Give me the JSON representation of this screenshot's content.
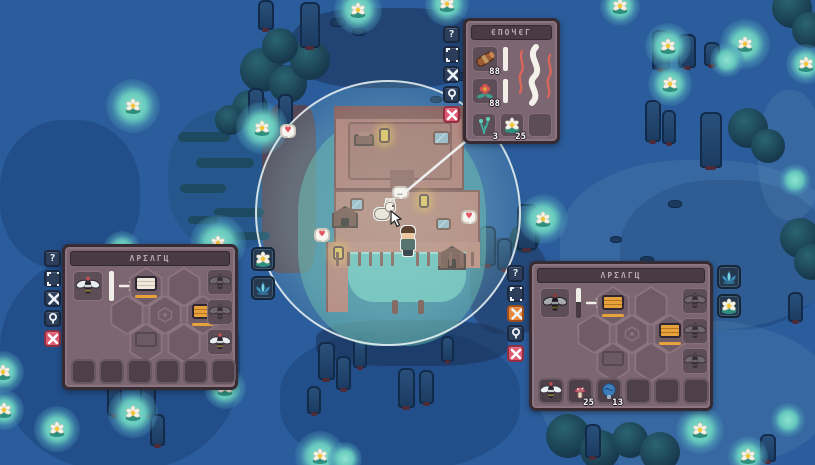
{
  "hud": {
    "help_glyph": "?",
    "smoker": {
      "title": "ЄΠΟЧЄΓ",
      "side_buttons": [
        "help",
        "resize",
        "move",
        "pin",
        "close"
      ],
      "fuel_slots": [
        {
          "item": "log",
          "timer": "88"
        },
        {
          "item": "red-flower",
          "timer": "88"
        }
      ],
      "output_slots": [
        {
          "item": "water-sprout",
          "count": "3"
        },
        {
          "item": "lily-flower",
          "count": "25"
        },
        {
          "item": "",
          "count": ""
        }
      ]
    },
    "apiary_left": {
      "title": "ΛΡΣΛΓЦ",
      "side_buttons": [
        "help",
        "resize",
        "move",
        "pin",
        "close"
      ],
      "input_item": "bee",
      "gauge_fill": "100%",
      "queue_slots": [
        "bee-silhouette",
        "bee-silhouette",
        "bee"
      ],
      "hex_cells": [
        "hive-box-white",
        "empty",
        "empty",
        "hex-marker",
        "hive-box-orange",
        "hive-box-faded",
        "empty"
      ],
      "inventory": [
        {
          "item": "",
          "count": ""
        },
        {
          "item": "",
          "count": ""
        },
        {
          "item": "",
          "count": ""
        },
        {
          "item": "",
          "count": ""
        },
        {
          "item": "",
          "count": ""
        },
        {
          "item": "",
          "count": ""
        }
      ],
      "floating_buttons": [
        "lily-flower",
        "lotus-flower"
      ]
    },
    "apiary_right": {
      "title": "ΛΡΣΛΓЦ",
      "side_buttons": [
        "help",
        "resize",
        "move-active",
        "pin",
        "close"
      ],
      "input_item": "bee",
      "gauge_fill": "45%",
      "queue_slots": [
        "bee-silhouette",
        "bee-silhouette",
        "bee-silhouette"
      ],
      "hex_cells": [
        "hive-box-orange",
        "empty",
        "empty",
        "hex-marker",
        "hive-box-orange",
        "hive-box-faded",
        "empty"
      ],
      "inventory": [
        {
          "item": "bee",
          "count": ""
        },
        {
          "item": "mushroom",
          "count": "25"
        },
        {
          "item": "blue-mushroom",
          "count": "13"
        },
        {
          "item": "",
          "count": ""
        },
        {
          "item": "",
          "count": ""
        },
        {
          "item": "",
          "count": ""
        }
      ],
      "floating_buttons": [
        "lotus-flower",
        "lily-flower"
      ]
    }
  },
  "world": {
    "speech_bubble": "…",
    "heart": "♥",
    "lilies": [
      {
        "x": 133,
        "y": 106,
        "s": 54,
        "f": true
      },
      {
        "x": 262,
        "y": 128,
        "s": 52,
        "f": true
      },
      {
        "x": 218,
        "y": 243,
        "s": 56,
        "f": true
      },
      {
        "x": 122,
        "y": 250,
        "s": 38,
        "f": false
      },
      {
        "x": 358,
        "y": 10,
        "s": 48,
        "f": true
      },
      {
        "x": 447,
        "y": 4,
        "s": 44,
        "f": true
      },
      {
        "x": 620,
        "y": 6,
        "s": 40,
        "f": true
      },
      {
        "x": 668,
        "y": 46,
        "s": 46,
        "f": true
      },
      {
        "x": 745,
        "y": 44,
        "s": 50,
        "f": true
      },
      {
        "x": 727,
        "y": 60,
        "s": 34,
        "f": false
      },
      {
        "x": 670,
        "y": 84,
        "s": 44,
        "f": true
      },
      {
        "x": 806,
        "y": 64,
        "s": 40,
        "f": true
      },
      {
        "x": 543,
        "y": 219,
        "s": 50,
        "f": true
      },
      {
        "x": 795,
        "y": 180,
        "s": 32,
        "f": false
      },
      {
        "x": 3,
        "y": 372,
        "s": 42,
        "f": true
      },
      {
        "x": 4,
        "y": 410,
        "s": 40,
        "f": true
      },
      {
        "x": 57,
        "y": 429,
        "s": 46,
        "f": true
      },
      {
        "x": 133,
        "y": 413,
        "s": 50,
        "f": true
      },
      {
        "x": 169,
        "y": 303,
        "s": 34,
        "f": false
      },
      {
        "x": 225,
        "y": 388,
        "s": 42,
        "f": true
      },
      {
        "x": 320,
        "y": 456,
        "s": 50,
        "f": true
      },
      {
        "x": 345,
        "y": 459,
        "s": 34,
        "f": false
      },
      {
        "x": 700,
        "y": 430,
        "s": 48,
        "f": true
      },
      {
        "x": 748,
        "y": 456,
        "s": 40,
        "f": true
      },
      {
        "x": 788,
        "y": 420,
        "s": 34,
        "f": false
      },
      {
        "x": 95,
        "y": 335,
        "s": 32,
        "f": false
      }
    ],
    "trunks": [
      {
        "x": 248,
        "y": 88,
        "w": 16,
        "h": 36
      },
      {
        "x": 278,
        "y": 94,
        "w": 15,
        "h": 34
      },
      {
        "x": 300,
        "y": 2,
        "w": 20,
        "h": 46
      },
      {
        "x": 258,
        "y": 0,
        "w": 16,
        "h": 30
      },
      {
        "x": 652,
        "y": 30,
        "w": 18,
        "h": 40
      },
      {
        "x": 678,
        "y": 34,
        "w": 18,
        "h": 34
      },
      {
        "x": 704,
        "y": 42,
        "w": 16,
        "h": 24
      },
      {
        "x": 645,
        "y": 100,
        "w": 16,
        "h": 42
      },
      {
        "x": 662,
        "y": 110,
        "w": 14,
        "h": 34
      },
      {
        "x": 700,
        "y": 112,
        "w": 22,
        "h": 56
      },
      {
        "x": 479,
        "y": 226,
        "w": 17,
        "h": 40
      },
      {
        "x": 497,
        "y": 238,
        "w": 15,
        "h": 32
      },
      {
        "x": 517,
        "y": 204,
        "w": 20,
        "h": 46
      },
      {
        "x": 318,
        "y": 342,
        "w": 17,
        "h": 38
      },
      {
        "x": 336,
        "y": 356,
        "w": 15,
        "h": 34
      },
      {
        "x": 353,
        "y": 338,
        "w": 14,
        "h": 30
      },
      {
        "x": 398,
        "y": 368,
        "w": 17,
        "h": 40
      },
      {
        "x": 419,
        "y": 370,
        "w": 15,
        "h": 34
      },
      {
        "x": 307,
        "y": 386,
        "w": 14,
        "h": 28
      },
      {
        "x": 441,
        "y": 336,
        "w": 13,
        "h": 26
      },
      {
        "x": 93,
        "y": 348,
        "w": 16,
        "h": 36
      },
      {
        "x": 107,
        "y": 376,
        "w": 15,
        "h": 40
      },
      {
        "x": 140,
        "y": 382,
        "w": 16,
        "h": 34
      },
      {
        "x": 150,
        "y": 414,
        "w": 15,
        "h": 32
      },
      {
        "x": 585,
        "y": 424,
        "w": 16,
        "h": 34
      },
      {
        "x": 760,
        "y": 434,
        "w": 16,
        "h": 28
      },
      {
        "x": 788,
        "y": 292,
        "w": 15,
        "h": 30
      }
    ],
    "rocks": [
      {
        "x": 330,
        "y": 18,
        "w": 16,
        "h": 9
      },
      {
        "x": 352,
        "y": 28,
        "w": 14,
        "h": 8
      },
      {
        "x": 452,
        "y": 72,
        "w": 16,
        "h": 9
      },
      {
        "x": 468,
        "y": 60,
        "w": 12,
        "h": 7
      },
      {
        "x": 495,
        "y": 92,
        "w": 14,
        "h": 8
      },
      {
        "x": 430,
        "y": 96,
        "w": 12,
        "h": 7
      },
      {
        "x": 560,
        "y": 268,
        "w": 12,
        "h": 7
      },
      {
        "x": 585,
        "y": 300,
        "w": 16,
        "h": 9
      },
      {
        "x": 640,
        "y": 256,
        "w": 14,
        "h": 8
      },
      {
        "x": 610,
        "y": 236,
        "w": 12,
        "h": 7
      },
      {
        "x": 668,
        "y": 200,
        "w": 14,
        "h": 8
      },
      {
        "x": 640,
        "y": 320,
        "w": 16,
        "h": 9
      },
      {
        "x": 600,
        "y": 345,
        "w": 12,
        "h": 7
      },
      {
        "x": 533,
        "y": 370,
        "w": 14,
        "h": 8
      }
    ],
    "reeds": [
      {
        "x": 178,
        "y": 132,
        "w": 52,
        "h": 10
      },
      {
        "x": 196,
        "y": 158,
        "w": 58,
        "h": 10
      },
      {
        "x": 180,
        "y": 184,
        "w": 46,
        "h": 9
      },
      {
        "x": 214,
        "y": 208,
        "w": 50,
        "h": 9
      },
      {
        "x": 188,
        "y": 216,
        "w": 30,
        "h": 8
      },
      {
        "x": 230,
        "y": 232,
        "w": 40,
        "h": 8
      }
    ],
    "bushes": [
      {
        "x": 262,
        "y": 70,
        "s": 44
      },
      {
        "x": 288,
        "y": 84,
        "s": 38
      },
      {
        "x": 250,
        "y": 108,
        "s": 36
      },
      {
        "x": 310,
        "y": 60,
        "s": 40
      },
      {
        "x": 280,
        "y": 46,
        "s": 36
      },
      {
        "x": 230,
        "y": 120,
        "s": 30
      },
      {
        "x": 568,
        "y": 436,
        "s": 44
      },
      {
        "x": 600,
        "y": 450,
        "s": 40
      },
      {
        "x": 630,
        "y": 440,
        "s": 36
      },
      {
        "x": 660,
        "y": 452,
        "s": 40
      },
      {
        "x": 792,
        "y": 8,
        "s": 40
      },
      {
        "x": 810,
        "y": 30,
        "s": 36
      },
      {
        "x": 748,
        "y": 128,
        "s": 40
      },
      {
        "x": 768,
        "y": 146,
        "s": 34
      },
      {
        "x": 800,
        "y": 238,
        "s": 40
      },
      {
        "x": 812,
        "y": 262,
        "s": 36
      },
      {
        "x": 525,
        "y": 238,
        "s": 30
      }
    ]
  },
  "colors": {
    "water": "#2b5c9b",
    "glow": "#7fdccb",
    "panel": "#7b6671",
    "panel_dark": "#493b43",
    "accent_orange": "#e8a23c",
    "button_navy": "#2c3e59",
    "button_red": "#e05a72",
    "button_orange": "#e8883a",
    "cabin": "#c47b6d",
    "light_ring": "#ecf4f4"
  }
}
